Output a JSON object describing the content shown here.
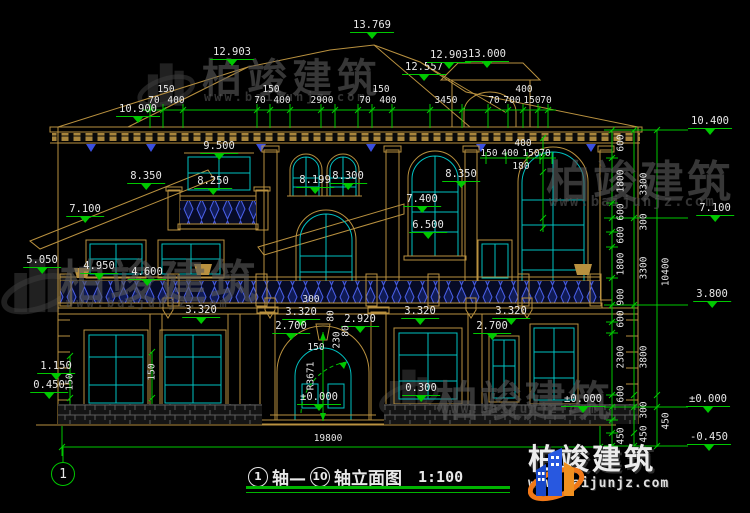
{
  "drawing_title": {
    "axis_start": "1",
    "axis_mid": "轴—",
    "axis_end": "10",
    "suffix": "轴立面图",
    "scale": "1:100"
  },
  "axis_bubble": "1",
  "watermark": {
    "brand": "柏竣建筑",
    "url": "www.baijunjz.com"
  },
  "logo": {
    "brand": "柏竣建筑",
    "url": "www.baijunjz.com"
  },
  "colors": {
    "dim_green": "#00c800",
    "line_tan": "#b9913f",
    "window_cyan": "#00c2c2",
    "baluster_blue": "#4a5fe8",
    "text_white": "#e8e8e8",
    "logo_orange": "#f07818",
    "logo_blue": "#2858e0"
  },
  "annotations": {
    "elevations": [
      {
        "t": "13.769",
        "x": 372,
        "y": 20
      },
      {
        "t": "12.903",
        "x": 232,
        "y": 47
      },
      {
        "t": "12.557",
        "x": 424,
        "y": 62
      },
      {
        "t": "12.903",
        "x": 449,
        "y": 50
      },
      {
        "t": "13.000",
        "x": 487,
        "y": 49
      },
      {
        "t": "10.900",
        "x": 138,
        "y": 104
      },
      {
        "t": "9.500",
        "x": 219,
        "y": 141
      },
      {
        "t": "8.350",
        "x": 146,
        "y": 171
      },
      {
        "t": "8.250",
        "x": 213,
        "y": 176
      },
      {
        "t": "8.199",
        "x": 315,
        "y": 175
      },
      {
        "t": "8.300",
        "x": 348,
        "y": 171
      },
      {
        "t": "8.350",
        "x": 461,
        "y": 169
      },
      {
        "t": "7.400",
        "x": 422,
        "y": 194
      },
      {
        "t": "7.100",
        "x": 85,
        "y": 204
      },
      {
        "t": "6.500",
        "x": 428,
        "y": 220
      },
      {
        "t": "5.050",
        "x": 42,
        "y": 255
      },
      {
        "t": "4.950",
        "x": 99,
        "y": 261
      },
      {
        "t": "4.600",
        "x": 147,
        "y": 267
      },
      {
        "t": "3.320",
        "x": 201,
        "y": 305
      },
      {
        "t": "3.320",
        "x": 301,
        "y": 307
      },
      {
        "t": "3.320",
        "x": 420,
        "y": 306
      },
      {
        "t": "3.320",
        "x": 511,
        "y": 306
      },
      {
        "t": "2.920",
        "x": 360,
        "y": 314
      },
      {
        "t": "2.700",
        "x": 291,
        "y": 321
      },
      {
        "t": "2.700",
        "x": 492,
        "y": 321
      },
      {
        "t": "1.150",
        "x": 56,
        "y": 361
      },
      {
        "t": "0.450",
        "x": 49,
        "y": 380
      },
      {
        "t": "0.300",
        "x": 421,
        "y": 383
      },
      {
        "t": "±0.000",
        "x": 319,
        "y": 392
      },
      {
        "t": "±0.000",
        "x": 583,
        "y": 394
      },
      {
        "t": "10.400",
        "x": 710,
        "y": 116
      },
      {
        "t": "7.100",
        "x": 715,
        "y": 203
      },
      {
        "t": "3.800",
        "x": 712,
        "y": 289
      },
      {
        "t": "±0.000",
        "x": 708,
        "y": 394
      },
      {
        "t": "-0.450",
        "x": 709,
        "y": 432
      }
    ],
    "dims": [
      {
        "t": "150",
        "x": 166,
        "y": 84
      },
      {
        "t": "150",
        "x": 271,
        "y": 84
      },
      {
        "t": "150",
        "x": 381,
        "y": 84
      },
      {
        "t": "400",
        "x": 524,
        "y": 84
      },
      {
        "t": "70",
        "x": 154,
        "y": 95
      },
      {
        "t": "400",
        "x": 176,
        "y": 95
      },
      {
        "t": "70",
        "x": 260,
        "y": 95
      },
      {
        "t": "400",
        "x": 282,
        "y": 95
      },
      {
        "t": "2900",
        "x": 322,
        "y": 95
      },
      {
        "t": "70",
        "x": 365,
        "y": 95
      },
      {
        "t": "400",
        "x": 388,
        "y": 95
      },
      {
        "t": "3450",
        "x": 446,
        "y": 95
      },
      {
        "t": "70",
        "x": 494,
        "y": 95
      },
      {
        "t": "700",
        "x": 512,
        "y": 95
      },
      {
        "t": "150",
        "x": 532,
        "y": 95
      },
      {
        "t": "70",
        "x": 546,
        "y": 95
      },
      {
        "t": "400",
        "x": 523,
        "y": 138
      },
      {
        "t": "150",
        "x": 489,
        "y": 148
      },
      {
        "t": "400",
        "x": 510,
        "y": 148
      },
      {
        "t": "150",
        "x": 531,
        "y": 148
      },
      {
        "t": "70",
        "x": 545,
        "y": 148
      },
      {
        "t": "180",
        "x": 521,
        "y": 161
      },
      {
        "t": "300",
        "x": 311,
        "y": 294
      },
      {
        "t": "150",
        "x": 316,
        "y": 342
      },
      {
        "t": "19800",
        "x": 328,
        "y": 433
      }
    ],
    "vdims": [
      {
        "t": "150",
        "x": 70,
        "y": 382
      },
      {
        "t": "150",
        "x": 152,
        "y": 372
      },
      {
        "t": "80",
        "x": 331,
        "y": 316
      },
      {
        "t": "230",
        "x": 337,
        "y": 340
      },
      {
        "t": "80",
        "x": 346,
        "y": 331
      },
      {
        "t": "R3671",
        "x": 311,
        "y": 376
      },
      {
        "t": "600",
        "x": 621,
        "y": 143
      },
      {
        "t": "1800",
        "x": 621,
        "y": 181
      },
      {
        "t": "600",
        "x": 621,
        "y": 212
      },
      {
        "t": "600",
        "x": 621,
        "y": 235
      },
      {
        "t": "1800",
        "x": 621,
        "y": 264
      },
      {
        "t": "900",
        "x": 621,
        "y": 297
      },
      {
        "t": "600",
        "x": 621,
        "y": 319
      },
      {
        "t": "2300",
        "x": 621,
        "y": 357
      },
      {
        "t": "600",
        "x": 621,
        "y": 394
      },
      {
        "t": "450",
        "x": 621,
        "y": 436
      },
      {
        "t": "3300",
        "x": 644,
        "y": 184
      },
      {
        "t": "300",
        "x": 644,
        "y": 222
      },
      {
        "t": "3300",
        "x": 644,
        "y": 268
      },
      {
        "t": "3800",
        "x": 644,
        "y": 357
      },
      {
        "t": "300",
        "x": 644,
        "y": 410
      },
      {
        "t": "450",
        "x": 644,
        "y": 434
      },
      {
        "t": "10400",
        "x": 666,
        "y": 272
      },
      {
        "t": "450",
        "x": 666,
        "y": 421
      }
    ]
  }
}
